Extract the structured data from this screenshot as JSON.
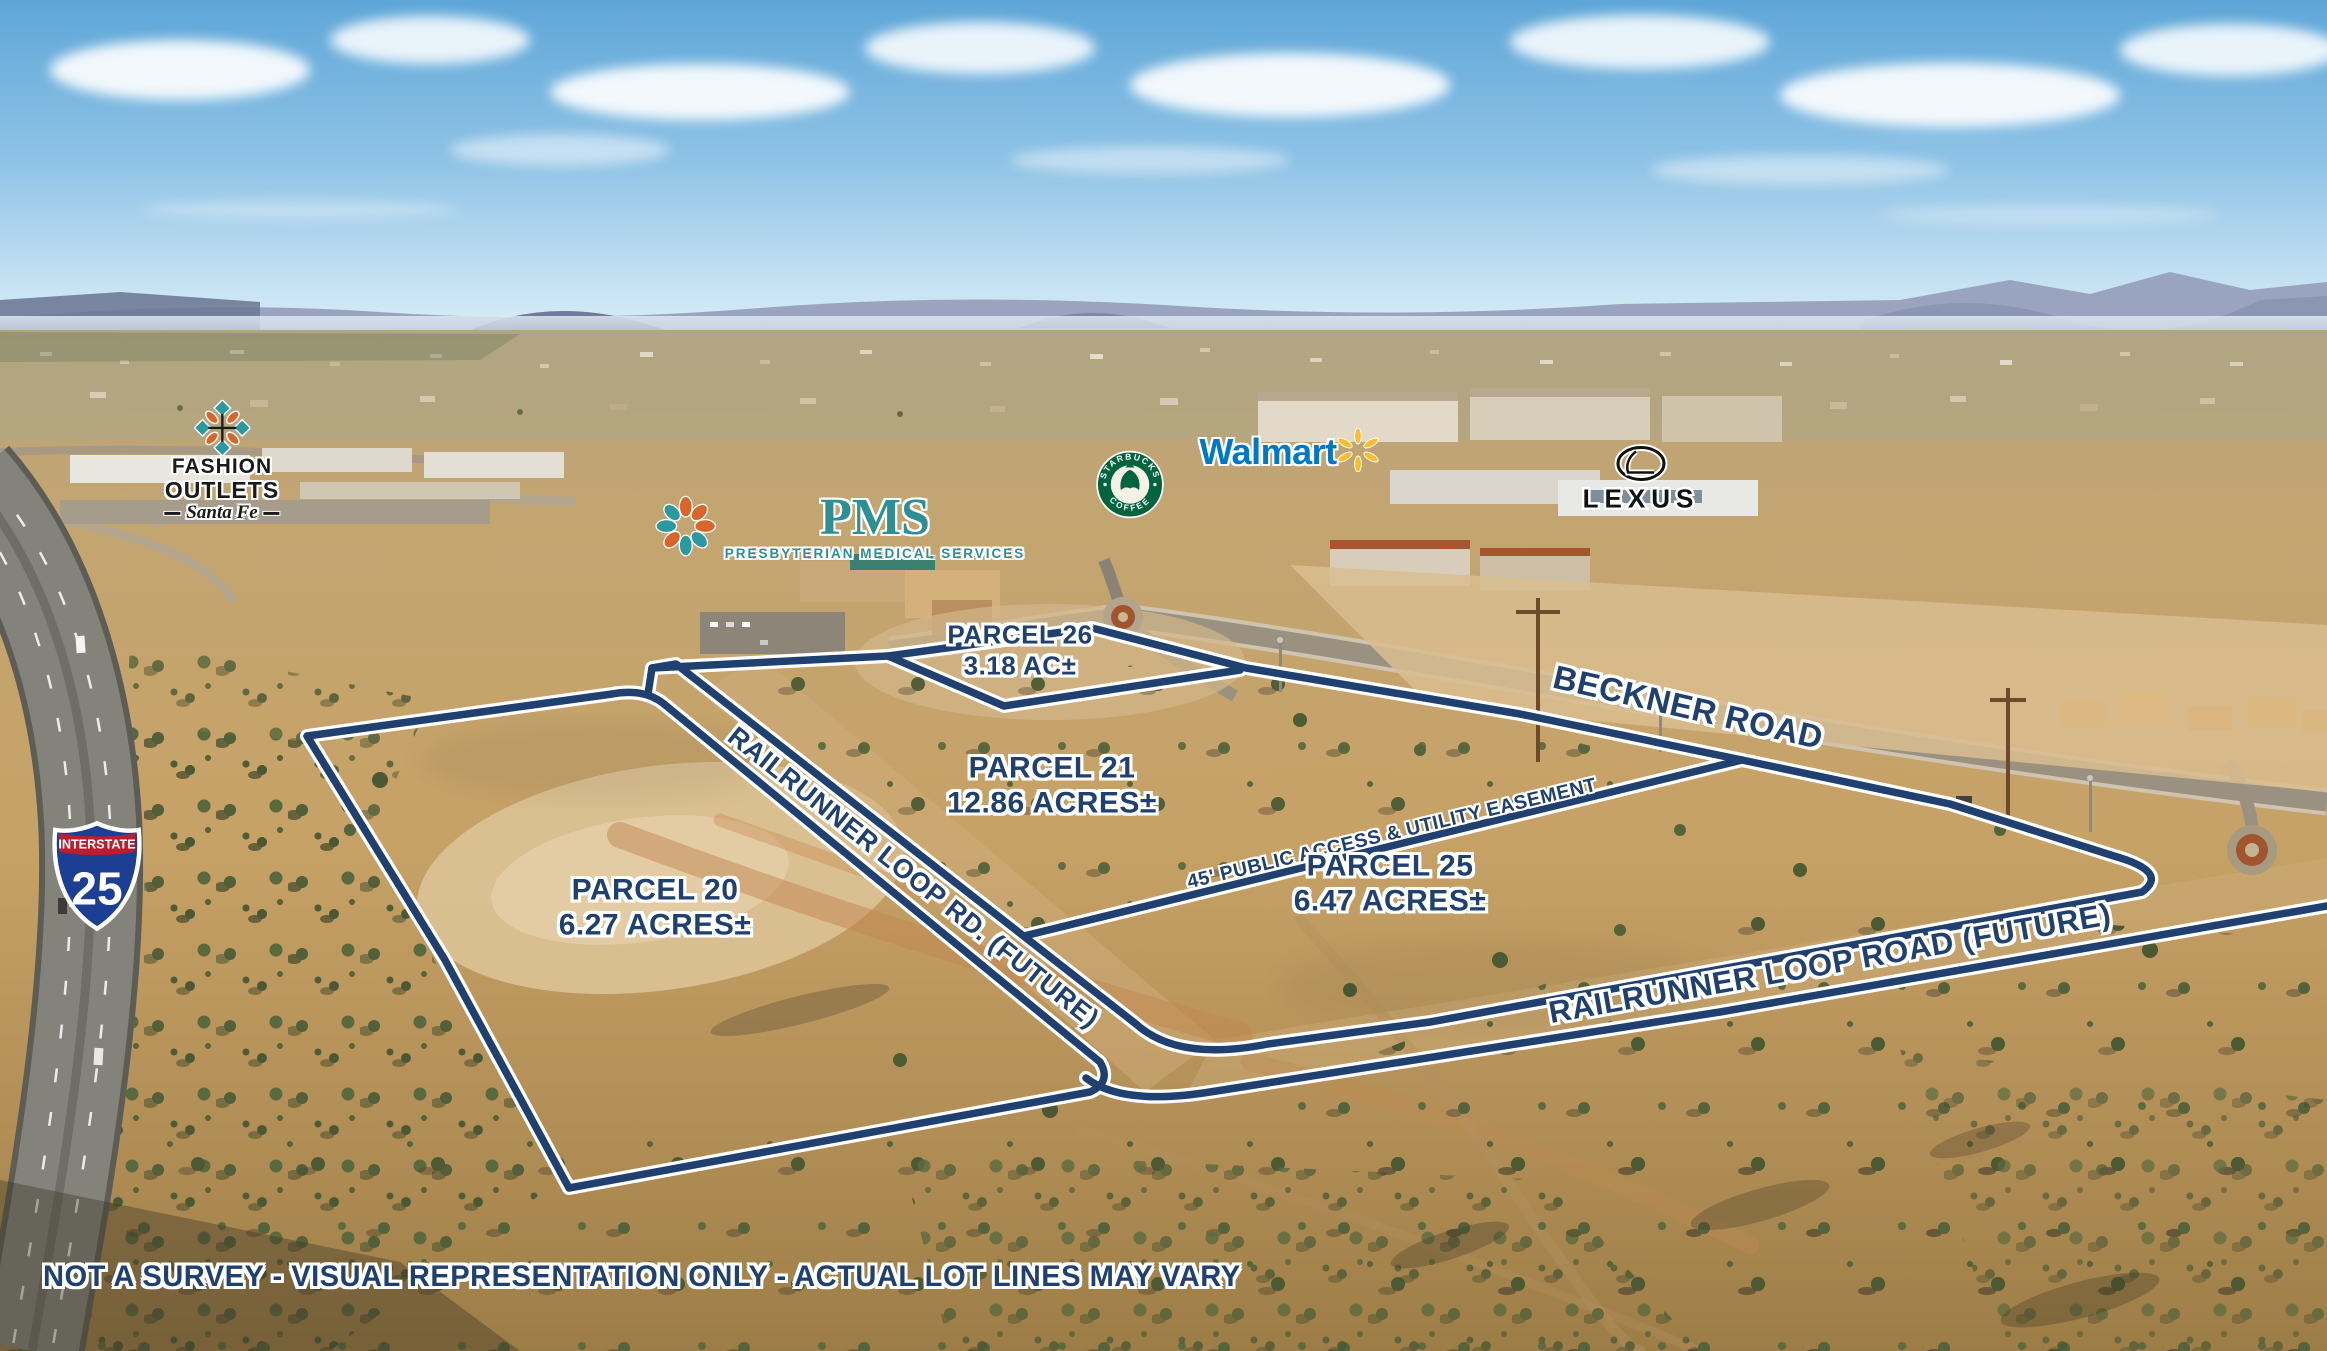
{
  "colors": {
    "annotation_navy": "#20406f",
    "annotation_outline": "#ffffff",
    "walmart_blue": "#0077c8",
    "walmart_spark_yellow": "#fdbb30",
    "starbucks_green": "#00653e",
    "pms_teal": "#2d8f93",
    "pms_orange": "#d9652b",
    "interstate_red": "#bf1d2d",
    "interstate_blue": "#1c3f94"
  },
  "parcels": [
    {
      "name": "PARCEL 26",
      "area": "3.18 AC±"
    },
    {
      "name": "PARCEL 21",
      "area": "12.86 ACRES±"
    },
    {
      "name": "PARCEL 20",
      "area": "6.27 ACRES±"
    },
    {
      "name": "PARCEL 25",
      "area": "6.47 ACRES±"
    }
  ],
  "roads": {
    "beckner": "BECKNER ROAD",
    "railrunner_rd": "RAILRUNNER LOOP RD. (FUTURE)",
    "railrunner_road": "RAILRUNNER LOOP ROAD (FUTURE)",
    "easement": "45' PUBLIC ACCESS & UTILITY EASEMENT"
  },
  "logos": {
    "fashion_outlets": {
      "line1": "FASHION",
      "line2": "OUTLETS",
      "line3": "Santa Fe"
    },
    "pms": {
      "abbr": "PMS",
      "subtitle": "PRESBYTERIAN MEDICAL SERVICES"
    },
    "starbucks": {
      "arc_top": "STARBUCKS",
      "arc_bottom": "COFFEE"
    },
    "walmart": {
      "wordmark": "Walmart"
    },
    "lexus": {
      "wordmark": "LEXUS"
    },
    "interstate": {
      "label": "INTERSTATE",
      "number": "25"
    }
  },
  "disclaimer": "NOT A SURVEY - VISUAL REPRESENTATION ONLY - ACTUAL LOT LINES MAY VARY"
}
